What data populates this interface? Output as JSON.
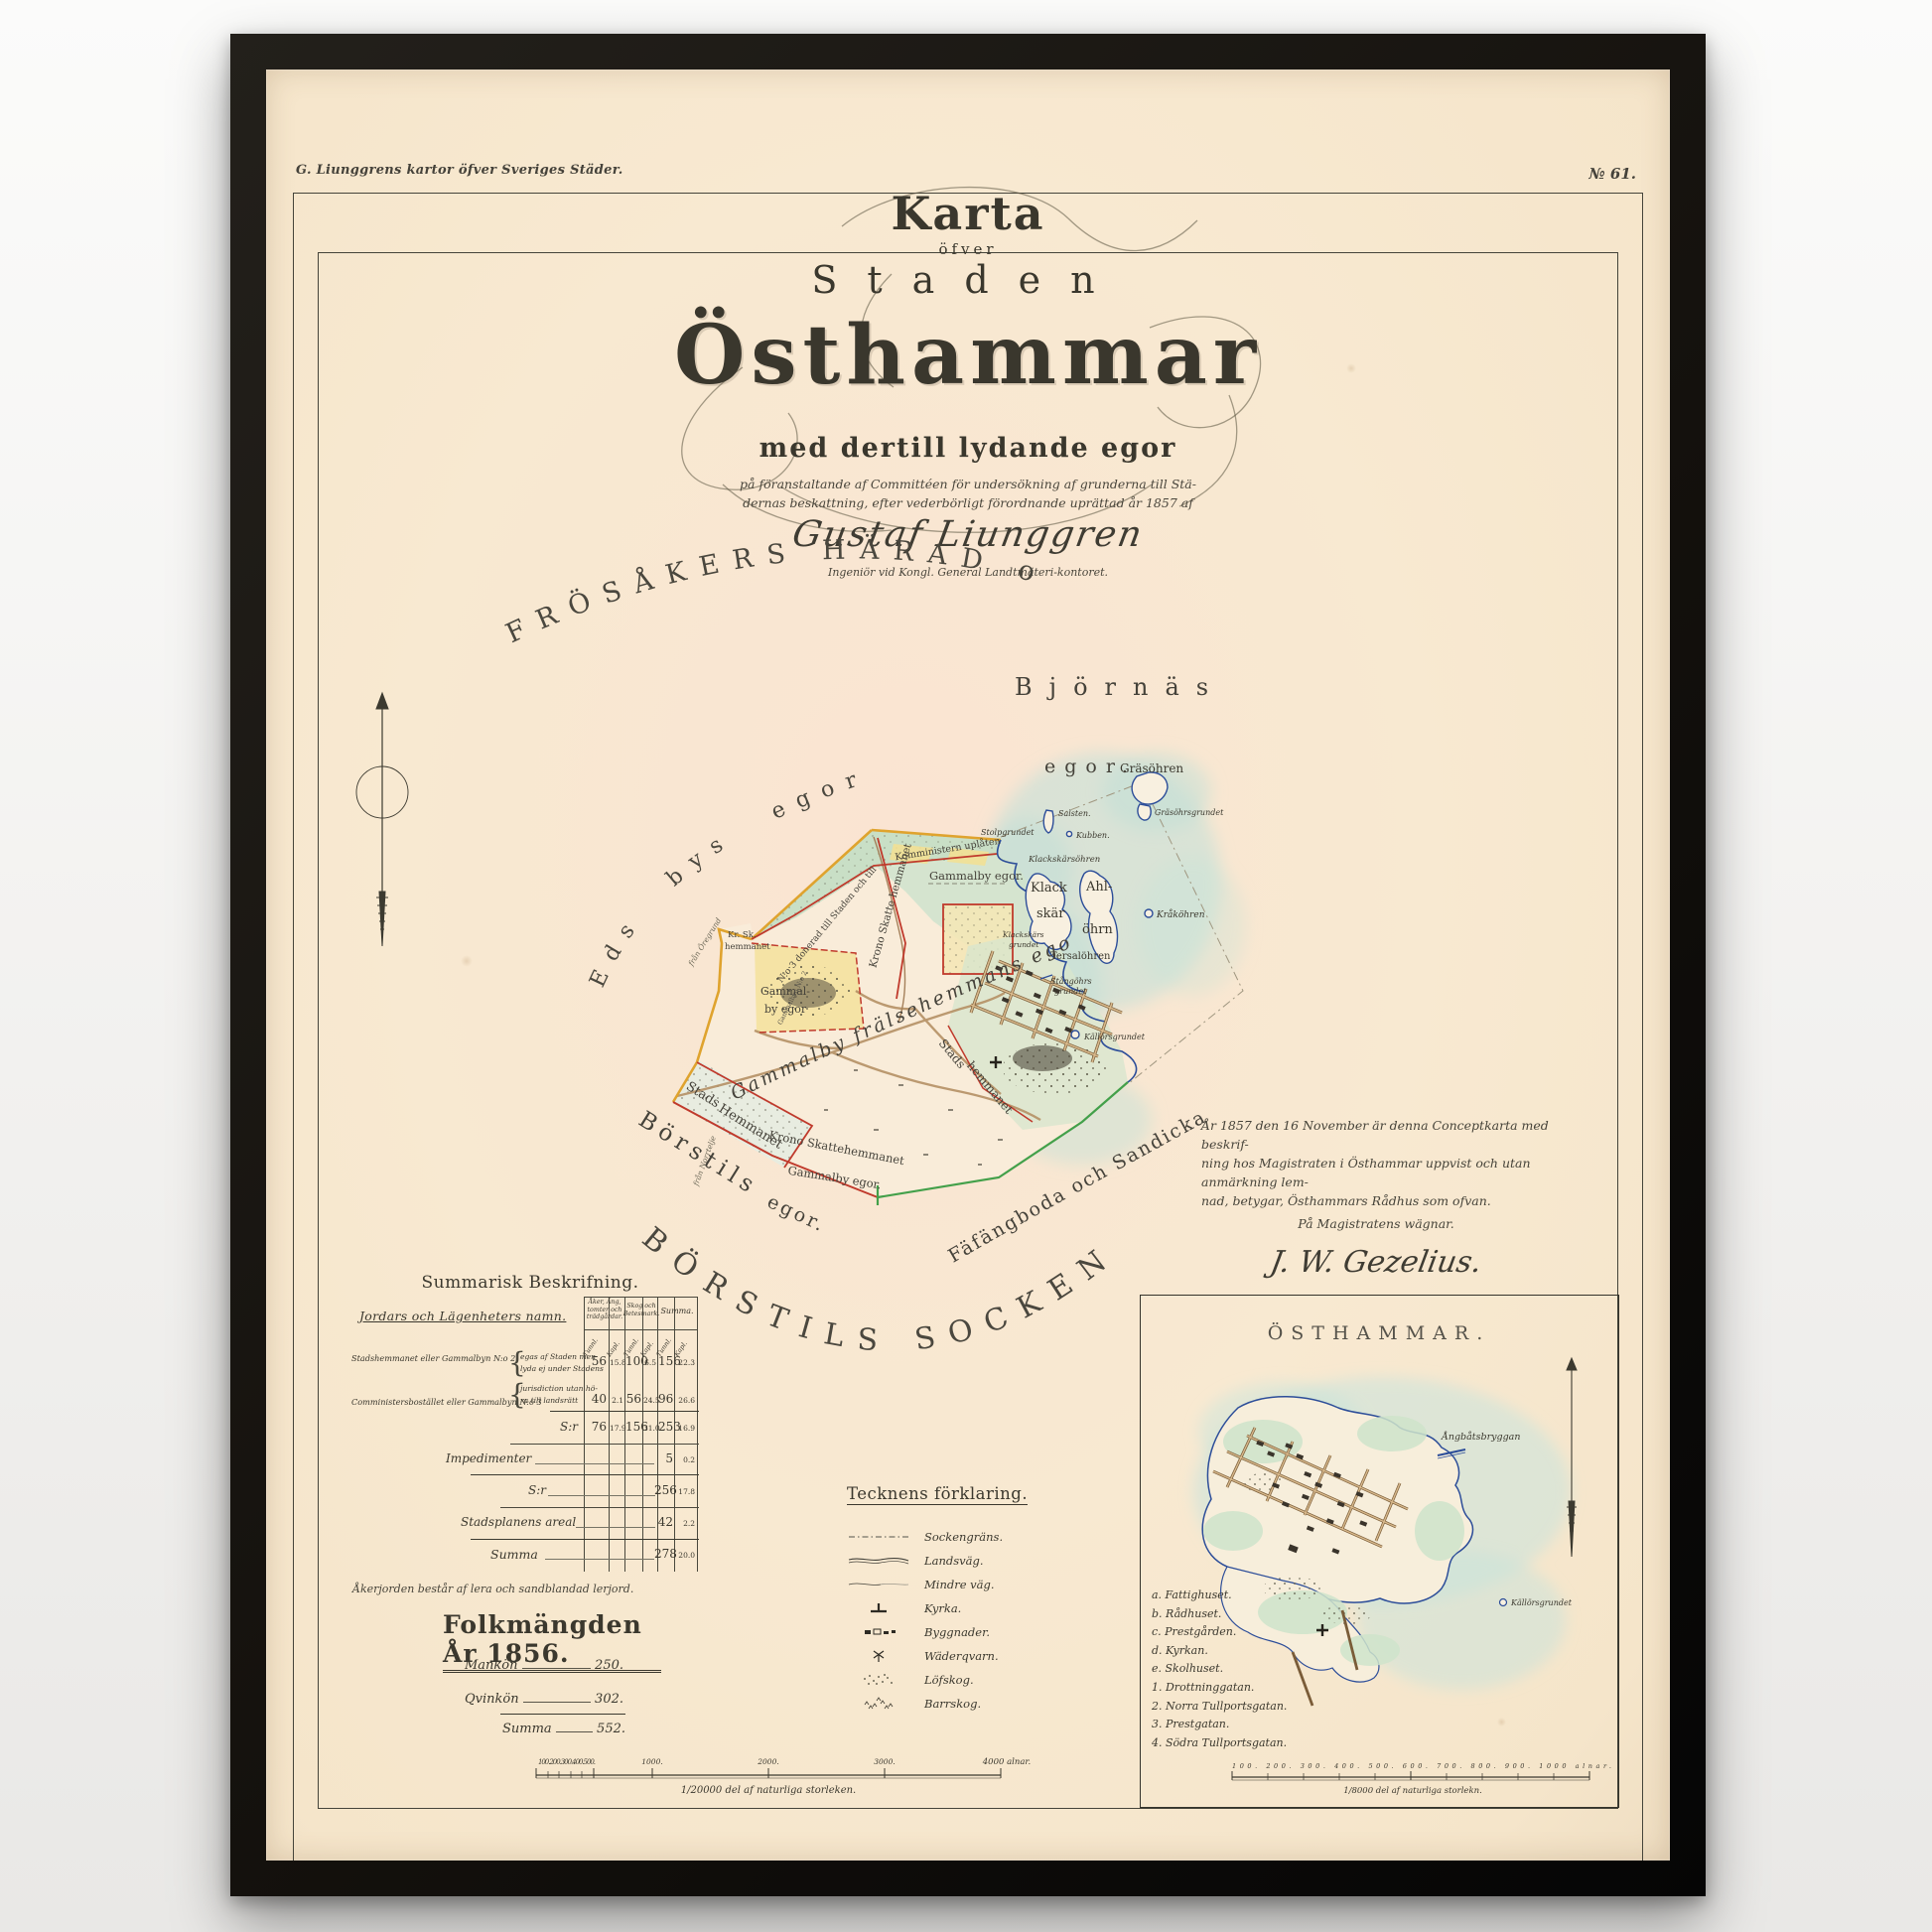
{
  "header": {
    "series_title": "G. Liunggrens kartor öfver Sveriges Städer.",
    "plate_number": "№ 61."
  },
  "title_block": {
    "karta": "Karta",
    "ofver": "öfver",
    "staden": "Staden",
    "osthammar": "Östhammar",
    "subtitle": "med dertill lydande egor",
    "dedication_line1": "på föranstaltande af Committéen för undersökning af grunderna till Stä-",
    "dedication_line2": "dernas beskattning, efter vederbörligt förordnande uprättad år 1857 af",
    "author_signature": "Gustaf Liunggren",
    "author_title": "Ingeniör vid Kongl. General Landtmäteri-kontoret."
  },
  "map_labels": {
    "district_arc": "FRÖSÅKERS HÄRAD och",
    "eds_bys_egor": "Eds bys egor",
    "bjornas": "Björnäs",
    "bjornas_egor": "egor.",
    "borstils": "Börstils",
    "borstils_egor": "egor.",
    "socken_arc": "BÖRSTILS SOCKEN.",
    "fafangboda_arc": "Fäfängboda och Sandicka egor.",
    "donerad_line": "N:o 3 donerad till Staden och till",
    "komministern_line": "Komministern uplåten",
    "gammalby_egor_north": "Gammalby egor.",
    "krono_skatte_vertical": "Krono Skatte hemmanet",
    "kr_sk_line1": "Kr. Sk.",
    "kr_sk_line2": "hemmanet",
    "gammalby_village_1": "Gammal-",
    "gammalby_village_2": "by egor",
    "gammalbyn_tiny": "Gammalbyn N:o 2",
    "fralse_arc": "Gammalby frälsehemmans egor",
    "stads_strip_1": "Stads",
    "stads_strip_2": "Hemmanet",
    "krono_skatte_south_1": "Krono Skattehemmanet",
    "krono_skatte_south_2": "Gammalby egor.",
    "stads_town_1": "Stads",
    "stads_town_2": "hemmanet",
    "fran_oregrund": "från Öregrund",
    "fran_norrtelje": "från Norrtelje"
  },
  "islands": {
    "grasohren": "Gräsöhren",
    "grasohrsgrundet": "Gräsöhrsgrundet",
    "salsten": "Salsten.",
    "kubben": "Kubben.",
    "stolpgrundet": "Stolpgrundet",
    "klackskarsohren": "Klackskärsöhren",
    "klack": "Klack",
    "skar": "skär",
    "ahl": "Ahl-",
    "ohrn": "öhrn",
    "krakohren": "Kråköhren",
    "tersalohren": "Tersalöhren",
    "stangohrs_1": "Stångöhrs",
    "stangohrs_2": "grundet",
    "kallorsgrundet": "Källörsgrundet",
    "klackskars_grund_1": "Klackskärs",
    "klackskars_grund_2": "grundet"
  },
  "certificate": {
    "line1": "År 1857 den 16 November är denna Conceptkarta med beskrif-",
    "line2": "ning hos Magistraten i Östhammar uppvist och utan anmärkning lem-",
    "line3": "nad, betygar, Östhammars Rådhus som ofvan.",
    "line4": "På Magistratens wägnar.",
    "signature": "J. W. Gezelius."
  },
  "summary_table": {
    "title": "Summarisk Beskrifning.",
    "name_header": "Jordars och Lägenheters namn.",
    "col_group_1a": "Åker, Äng,",
    "col_group_1b": "tomter och",
    "col_group_1c": "trädgårdar.",
    "col_group_2a": "Skog och",
    "col_group_2b": "Betesmark.",
    "col_group_3": "Summa.",
    "unit_tunnland": "Tunnl.",
    "unit_kappland": "Kapl.",
    "row1_name": "Stadshemmanet eller Gammalbyn N:o 2",
    "row2_name": "Comministersbostället eller Gammalbyn N:o 3",
    "note_line1": "egas af Staden men",
    "note_line2": "lyda ej under Stadens",
    "note_line3": "jurisdiction utan hö-",
    "note_line4": "ra till landsrätt",
    "row1": [
      "56",
      "15.8",
      "100",
      "6.5",
      "156",
      "22.3"
    ],
    "row2": [
      "40",
      "2.1",
      "56",
      "24.5",
      "96",
      "26.6"
    ],
    "subtotal_label": "S:r",
    "subtotal": [
      "76",
      "17.9",
      "156",
      "31.0",
      "253",
      "16.9"
    ],
    "impedimenter_label": "Impedimenter",
    "impedimenter": [
      "5",
      "0.2"
    ],
    "subtotal2_label": "S:r",
    "subtotal2": [
      "256",
      "17.8"
    ],
    "stadsplan_label": "Stadsplanens areal",
    "stadsplan": [
      "42",
      "2.2"
    ],
    "summa_label": "Summa",
    "summa": [
      "278",
      "20.0"
    ],
    "footnote": "Åkerjorden består af lera och sandblandad lerjord."
  },
  "population": {
    "title": "Folkmängden År 1856.",
    "mankon_label": "Mankön",
    "mankon_value": "250.",
    "qvinkon_label": "Qvinkön",
    "qvinkon_value": "302.",
    "summa_label": "Summa",
    "summa_value": "552."
  },
  "legend": {
    "title": "Tecknens förklaring.",
    "items": [
      {
        "symbol": "sockengrans",
        "label": "Sockengräns."
      },
      {
        "symbol": "landsvag",
        "label": "Landsväg."
      },
      {
        "symbol": "mindre-vag",
        "label": "Mindre väg."
      },
      {
        "symbol": "kyrka",
        "label": "Kyrka."
      },
      {
        "symbol": "byggnader",
        "label": "Byggnader."
      },
      {
        "symbol": "vaderqvarn",
        "label": "Wäderqvarn."
      },
      {
        "symbol": "lofskog",
        "label": "Löfskog."
      },
      {
        "symbol": "barrskog",
        "label": "Barrskog."
      }
    ]
  },
  "main_scale": {
    "subticks": "100.200.300.400.500.",
    "tick_1000": "1000.",
    "tick_2000": "2000.",
    "tick_3000": "3000.",
    "tick_4000": "4000 alnar.",
    "caption": "1/20000 del af naturliga storleken."
  },
  "inset": {
    "title": "ÖSTHAMMAR.",
    "angbatsbryggan": "Ångbåtsbryggan",
    "kallorsgrundet": "Källörsgrundet",
    "legend": [
      "a. Fattighuset.",
      "b. Rådhuset.",
      "c. Prestgården.",
      "d. Kyrkan.",
      "e. Skolhuset.",
      "1. Drottninggatan.",
      "2. Norra Tullportsgatan.",
      "3. Prestgatan.",
      "4. Södra Tullportsgatan."
    ],
    "scale_subticks": "100. 200. 300. 400. 500. 600. 700. 800. 900. 1000 alnar.",
    "scale_caption": "1/8000 del af naturliga storlekn."
  },
  "colors": {
    "paper": "#f8e9d1",
    "frame": "#14110d",
    "ink": "#3b382e",
    "boundary_red": "#c03a2c",
    "boundary_orange": "#dfa32e",
    "boundary_green": "#43a04a",
    "coast_blue": "#2c4d99",
    "water": "#c5e2da",
    "parcel_green": "#c9dfc6",
    "parcel_yellow": "#f2e094",
    "road_tan": "#c2a075"
  }
}
